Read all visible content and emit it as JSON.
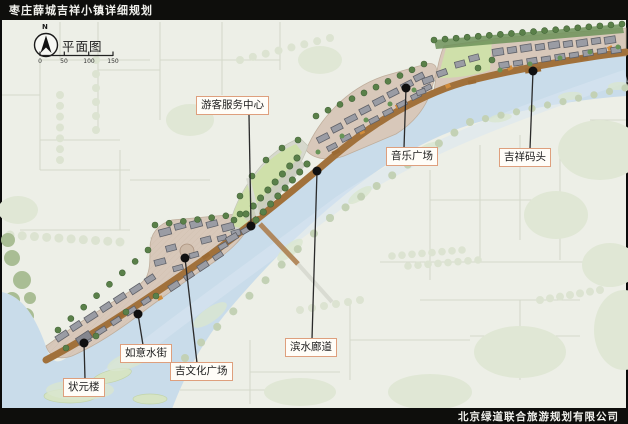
{
  "header": {
    "title": "枣庄薛城吉祥小镇详细规划"
  },
  "footer": {
    "company": "北京绿道联合旅游规划有限公司"
  },
  "map": {
    "compass": {
      "north": "N",
      "label": "平面图"
    },
    "scale": {
      "ticks": [
        "0",
        "50",
        "100",
        "150"
      ]
    },
    "labels": [
      {
        "id": "visitor-center",
        "text": "游客服务中心"
      },
      {
        "id": "music-plaza",
        "text": "音乐广场"
      },
      {
        "id": "jixiang-wharf",
        "text": "吉祥码头"
      },
      {
        "id": "waterfront-corridor",
        "text": "滨水廊道"
      },
      {
        "id": "ruyi-water-street",
        "text": "如意水街"
      },
      {
        "id": "ji-culture-plaza",
        "text": "吉文化广场"
      },
      {
        "id": "zhuangyuan-tower",
        "text": "状元楼"
      }
    ],
    "colors": {
      "bar": "#0e0e0c",
      "map_background": "#edefe7",
      "river": "#c9dcea",
      "promenade": "#a1713b",
      "paving": "#d8c8ba",
      "building": "#9a9ca4",
      "tree": "#5a8049",
      "lawn": "#cfe0aa",
      "label_border": "#de9f7d"
    }
  }
}
